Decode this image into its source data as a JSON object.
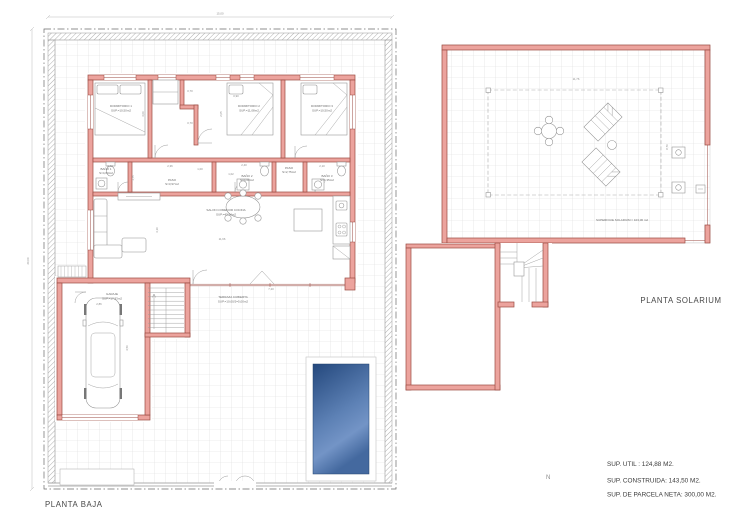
{
  "plan": {
    "baja": {
      "title": "PLANTA BAJA",
      "rooms": [
        {
          "name": "DORMITORIO 1",
          "area": "SUP.=10,50m2"
        },
        {
          "name": "DORMITORIO 2",
          "area": "SUP.=11,08m2"
        },
        {
          "name": "DORMITORIO 3",
          "area": "SUP.=10,50m2"
        },
        {
          "name": "BAÑO 1",
          "area": "S=4,60m2"
        },
        {
          "name": "PASO",
          "area": "S=3,97m2"
        },
        {
          "name": "BAÑO 2",
          "area": "S=4,60m2"
        },
        {
          "name": "PASO",
          "area": "S=2,75m2"
        },
        {
          "name": "BAÑO 3",
          "area": "S=4,35m2"
        },
        {
          "name": "SALON COMEDOR COCINA",
          "area": "SUP.=43,14m2"
        },
        {
          "name": "GARAJE",
          "area": "SUP.=17,93m2"
        },
        {
          "name": "TERRAZA CUBIERTA",
          "area": "SUP.=10,00/2=5,00m2"
        }
      ],
      "dims": {
        "parcel_w": "15,00",
        "parcel_h": "20,00",
        "salon_w": "11,66",
        "salon_h": "3,10",
        "terraza_w": "7,20",
        "garaje_w": "2,86",
        "garaje_h": "4,56"
      },
      "small_dims": [
        "2,62",
        "1,75",
        "2,36",
        "1,00",
        "2,40",
        "1,02",
        "2,10",
        "3,06",
        "2,05",
        "0,70",
        "0,70",
        "0,90"
      ]
    },
    "solarium": {
      "title": "PLANTA SOLARIUM",
      "surface": "SUPERFICIE SOLARIUM = 103,06 m2",
      "dims": {
        "width": "11,76",
        "height": "8,76"
      }
    }
  },
  "summary": {
    "lines": [
      "SUP. UTIL : 124,88 M2.",
      "SUP. CONSTRUIDA: 143,50 M2.",
      "SUP. DE PARCELA NETA: 300,00 M2."
    ]
  },
  "north_label": "N",
  "colors": {
    "wall_fill": "#ECA39D",
    "wall_stroke": "#9B4A42",
    "pool_top": "#24487D",
    "pool_light": "#7394C6",
    "pool_bottom": "#44699F",
    "grid_line": "#DCDCDC"
  }
}
